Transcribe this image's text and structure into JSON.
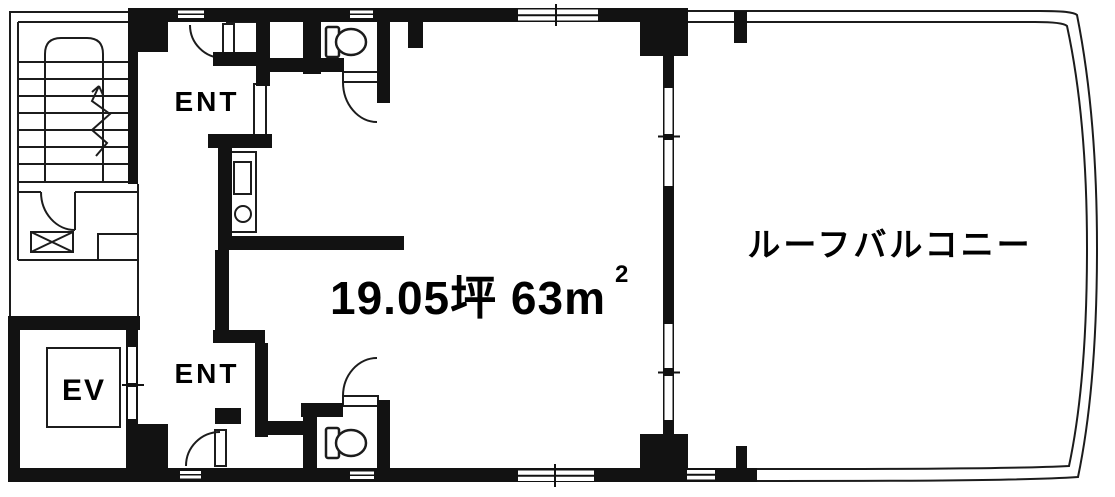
{
  "floor_plan": {
    "labels": {
      "entrance_upper": "ENT",
      "entrance_lower": "ENT",
      "elevator": "EV",
      "area_value": "19.05坪 63m",
      "area_superscript": "2",
      "roof_balcony": "ルーフバルコニー"
    },
    "colors": {
      "wall": "#121212",
      "line": "#1c1c1c",
      "background": "#ffffff",
      "text": "#000000"
    }
  }
}
